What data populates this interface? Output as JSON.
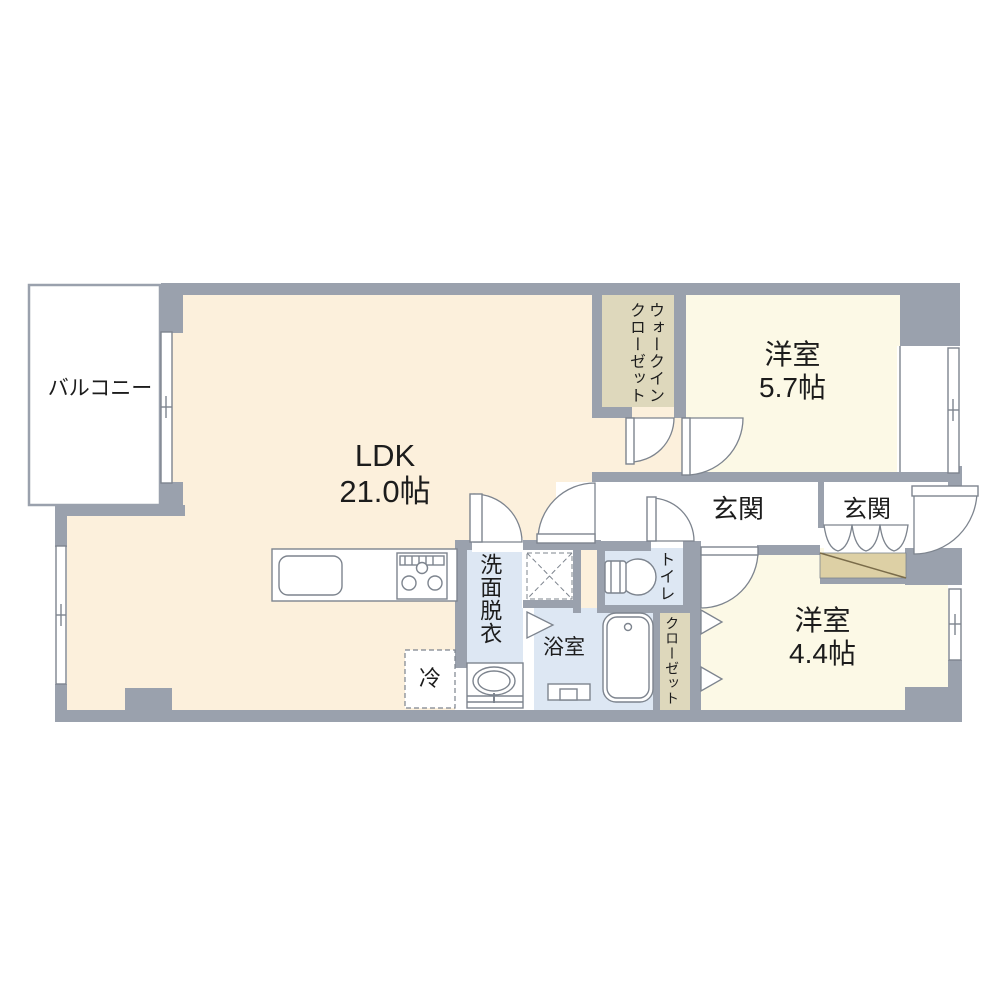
{
  "floor_plan": {
    "rooms": {
      "balcony": {
        "label": "バルコニー"
      },
      "ldk": {
        "label": "LDK",
        "size": "21.0帖"
      },
      "walk_in_closet": {
        "label": "ウォークインクローゼット"
      },
      "western_room_1": {
        "label": "洋室",
        "size": "5.7帖"
      },
      "entrance_1": {
        "label": "玄関"
      },
      "entrance_2": {
        "label": "玄関"
      },
      "toilet": {
        "label": "トイレ"
      },
      "washroom": {
        "label": "洗面脱衣"
      },
      "bathroom": {
        "label": "浴室"
      },
      "closet": {
        "label": "クローゼット"
      },
      "western_room_2": {
        "label": "洋室",
        "size": "4.4帖"
      },
      "refrigerator": {
        "label": "冷"
      }
    },
    "colors": {
      "wall": "#9aa1ad",
      "thin_line": "#7d848e",
      "ldk_fill": "#fcf0dc",
      "bedroom_fill": "#fcf9e6",
      "wet_area_fill": "#dde7f3",
      "closet_fill": "#ded8bc",
      "cabinet_fill": "#ddd0a5",
      "text": "#1c1c1c"
    }
  }
}
